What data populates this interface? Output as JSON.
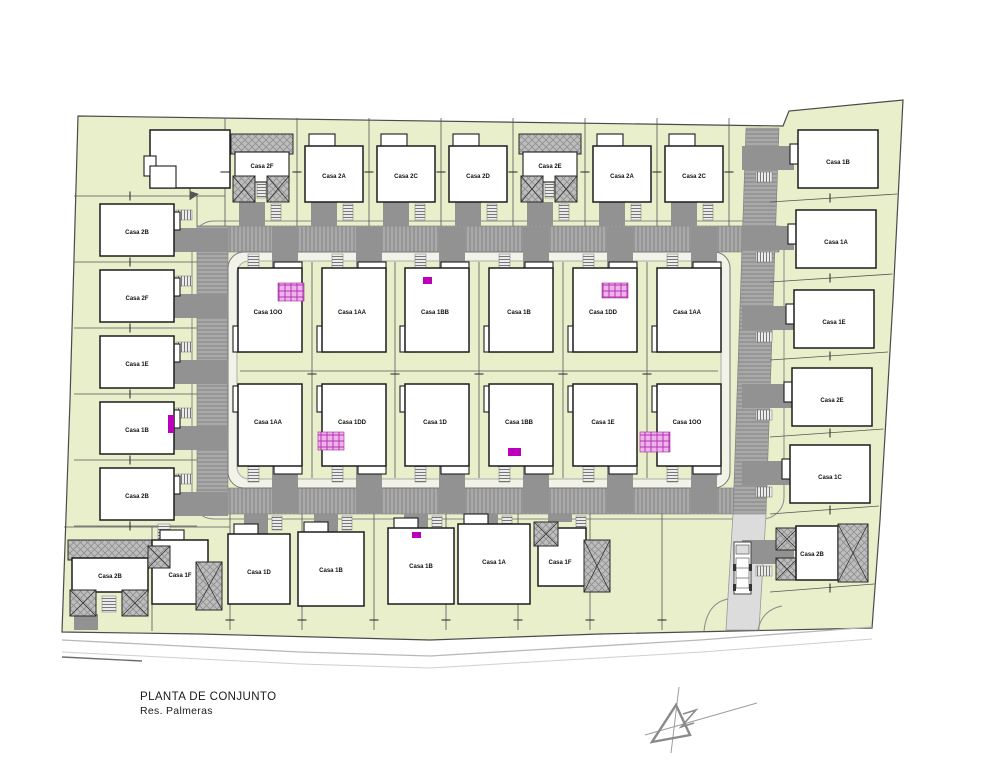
{
  "drawing": {
    "title": "PLANTA DE CONJUNTO",
    "subtitle": "Res. Palmeras"
  },
  "houses": {
    "top_row": [
      "Casa 2F",
      "Casa 2A",
      "Casa 2C",
      "Casa 2D",
      "Casa 2E",
      "Casa 2A",
      "Casa 2C"
    ],
    "inner_top_row": [
      "Casa 1OO",
      "Casa 1AA",
      "Casa 1BB",
      "Casa 1B",
      "Casa 1DD",
      "Casa 1AA"
    ],
    "inner_bottom_row": [
      "Casa 1AA",
      "Casa 1DD",
      "Casa 1D",
      "Casa 1BB",
      "Casa 1E",
      "Casa 1OO"
    ],
    "left_column": [
      "Casa 2B",
      "Casa 2F",
      "Casa 1E",
      "Casa 1B",
      "Casa 2B"
    ],
    "right_column": [
      "Casa 1B",
      "Casa 1A",
      "Casa 1E",
      "Casa 2E",
      "Casa 1C",
      "Casa 2B"
    ],
    "bottom_left": [
      "Casa 2B",
      "Casa 1F"
    ],
    "bottom_row": [
      "Casa 1D",
      "Casa 1B",
      "Casa 1B",
      "Casa 1A",
      "Casa 1F"
    ]
  },
  "icons": {
    "north_arrow": "north-arrow-icon",
    "vehicle": "truck-icon"
  },
  "colors": {
    "lawn": "#e9eecb",
    "road": "#a9a9a9",
    "road_stripe": "#8d8d8d",
    "roof": "#bdbdbd",
    "drive": "#929292",
    "house_fill": "#ffffff",
    "outline": "#1c1c1c",
    "walkway": "#f2f2e9",
    "exit_road": "#dcdcdc",
    "stair_pink_fill": "#efb3ec",
    "stair_pink_line": "#b534b0",
    "accent_magenta": "#bb00bb"
  }
}
